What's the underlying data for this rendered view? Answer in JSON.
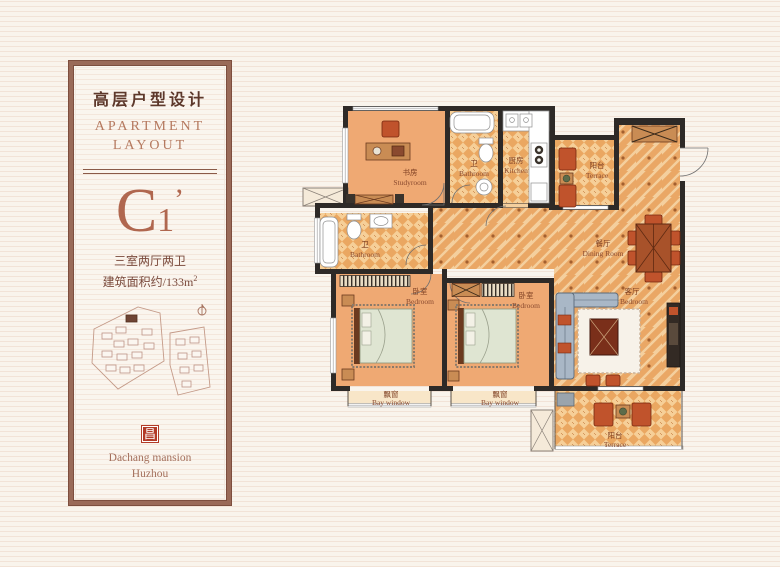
{
  "panel": {
    "title_cn": "高层户型设计",
    "title_en_1": "APARTMENT",
    "title_en_2": "LAYOUT",
    "unit": {
      "letter": "C",
      "subscript": "1",
      "prime": "’"
    },
    "spec_rooms": "三室两厅两卫",
    "spec_area_prefix": "建筑面积约/133m",
    "spec_area_sup": "2",
    "logo_glyph": "昌",
    "developer": "Dachang mansion",
    "city": "Huzhou"
  },
  "floorplan": {
    "rooms": [
      {
        "id": "study",
        "label_cn": "书房",
        "label_en": "Studyroom"
      },
      {
        "id": "bath1",
        "label_cn": "卫",
        "label_en": "Bathroom"
      },
      {
        "id": "kitchen",
        "label_cn": "厨房",
        "label_en": "Kitchen"
      },
      {
        "id": "terrace1",
        "label_cn": "阳台",
        "label_en": "Terrace"
      },
      {
        "id": "dining",
        "label_cn": "餐厅",
        "label_en": "Dining Room"
      },
      {
        "id": "bath2",
        "label_cn": "卫",
        "label_en": "Bathroom"
      },
      {
        "id": "bedroom1",
        "label_cn": "卧室",
        "label_en": "Bedroom"
      },
      {
        "id": "bedroom2",
        "label_cn": "卧室",
        "label_en": "Bedroom"
      },
      {
        "id": "living",
        "label_cn": "客厅",
        "label_en": "Bedroom"
      },
      {
        "id": "bay1",
        "label_cn": "飘窗",
        "label_en": "Bay window"
      },
      {
        "id": "bay2",
        "label_cn": "飘窗",
        "label_en": "Bay window"
      },
      {
        "id": "terrace2",
        "label_cn": "阳台",
        "label_en": "Terrace"
      }
    ]
  },
  "colors": {
    "background": "#f9f4ec",
    "frame_brown": "#9a6a58",
    "accent_text": "#b0674f",
    "dark_text": "#5d382b",
    "wall": "#2e2a27",
    "floor_orange": "#efa973",
    "tile_light": "#f6cf98",
    "tile_dark": "#eaa761",
    "label_brown": "#8a4a2f",
    "logo_red": "#b23a28"
  }
}
